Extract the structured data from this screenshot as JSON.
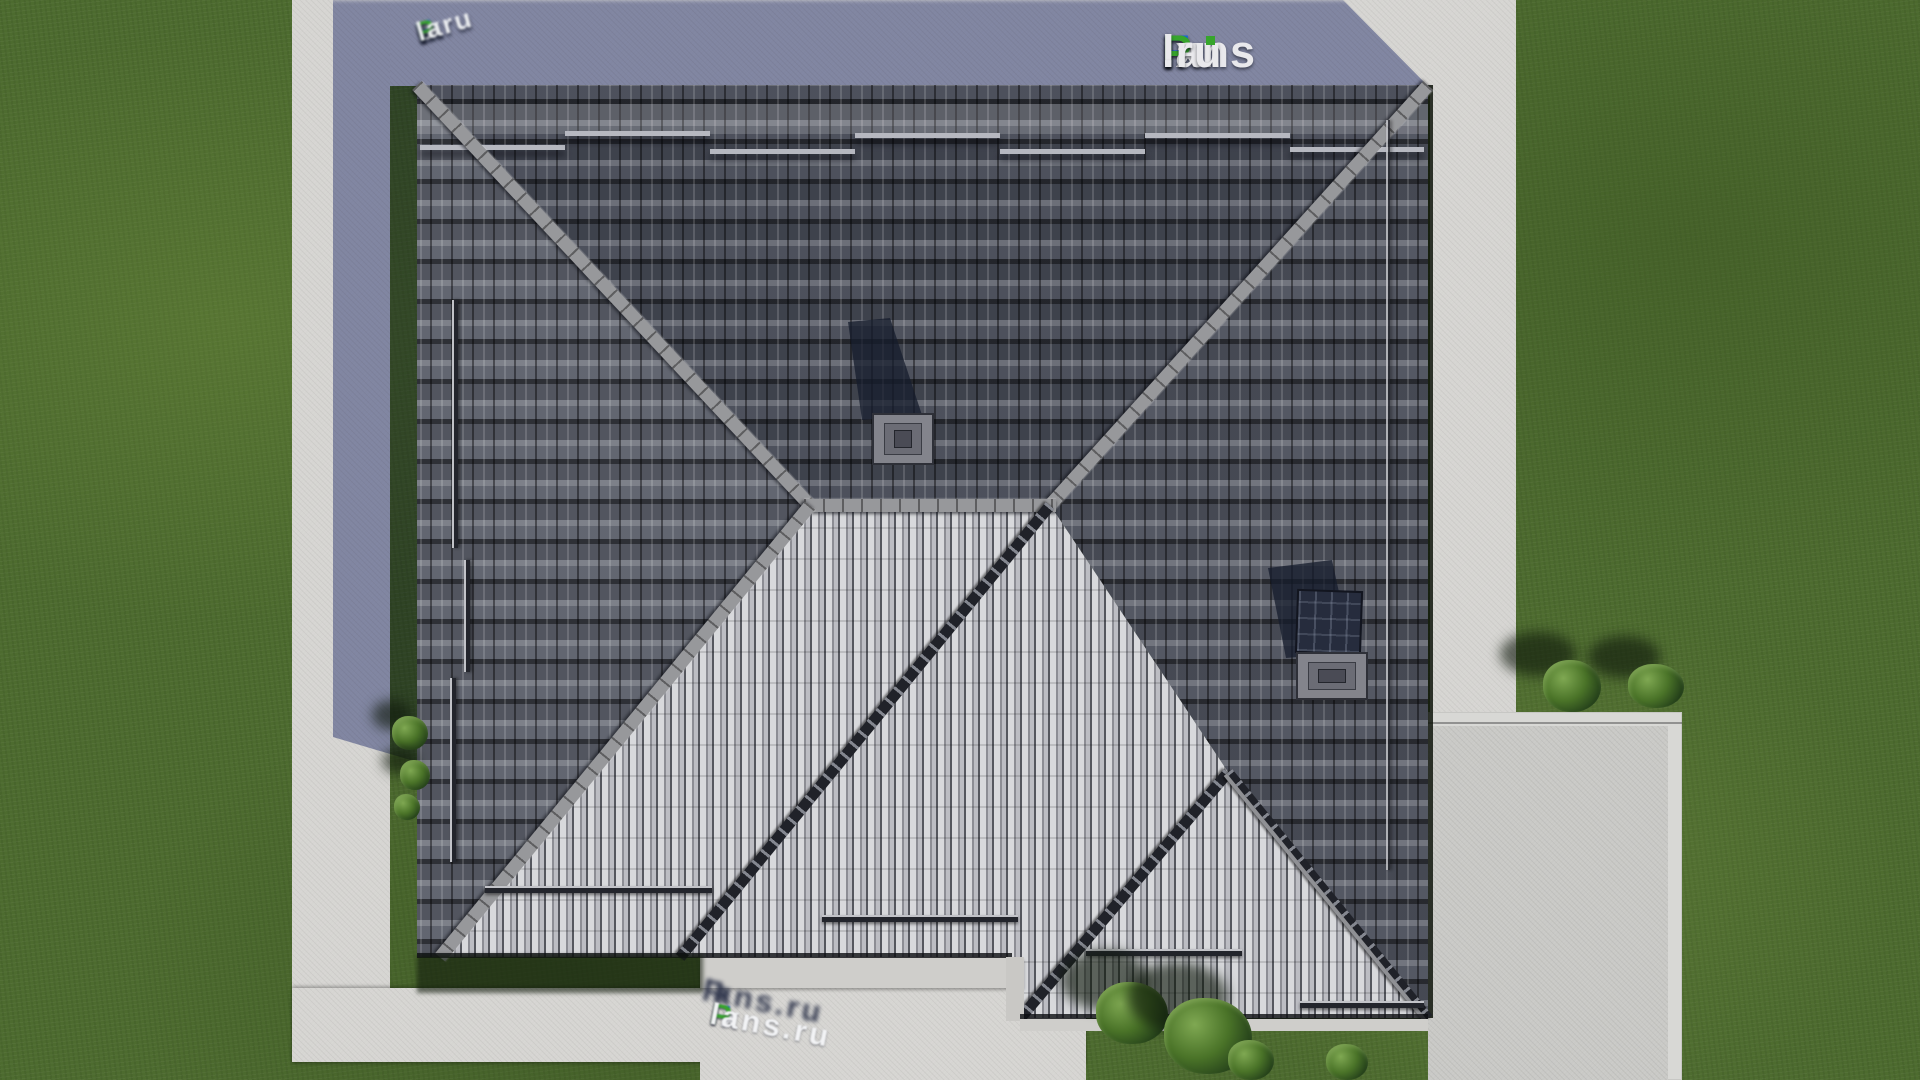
{
  "brand": {
    "f": "F",
    "ix": "ix",
    "p": "P",
    "lans": "lans",
    "dot_ru": ".ru",
    "full_name": "FixPlans.ru"
  },
  "watermark_top_left": {
    "pre": "s.ru ",
    "f": "F",
    "ix": "ix",
    "p": "P",
    "rest": "la"
  },
  "watermark_bottom": {
    "f": "F",
    "ix": "ix",
    "p": "P",
    "rest": "lans.ru",
    "full": "FixPlans.ru"
  },
  "colors": {
    "grass": "#4d6b2f",
    "grass_dark": "#2b3e1c",
    "pavement": "#d6d5d2",
    "pavement_shadow": "#5e637a",
    "driveway": "#c9c9c6",
    "hedge": "#17260f",
    "roof_top": "#474b57",
    "roof_left": "#5d616c",
    "roof_right": "#4f535e",
    "roof_light": "#a4a6ad",
    "ridge": "#97989b",
    "valley": "#202229",
    "solar": "#262c3d",
    "brand_blue": "#1769d6",
    "brand_green": "#37a52c",
    "brand_white": "#e9e9ec"
  }
}
